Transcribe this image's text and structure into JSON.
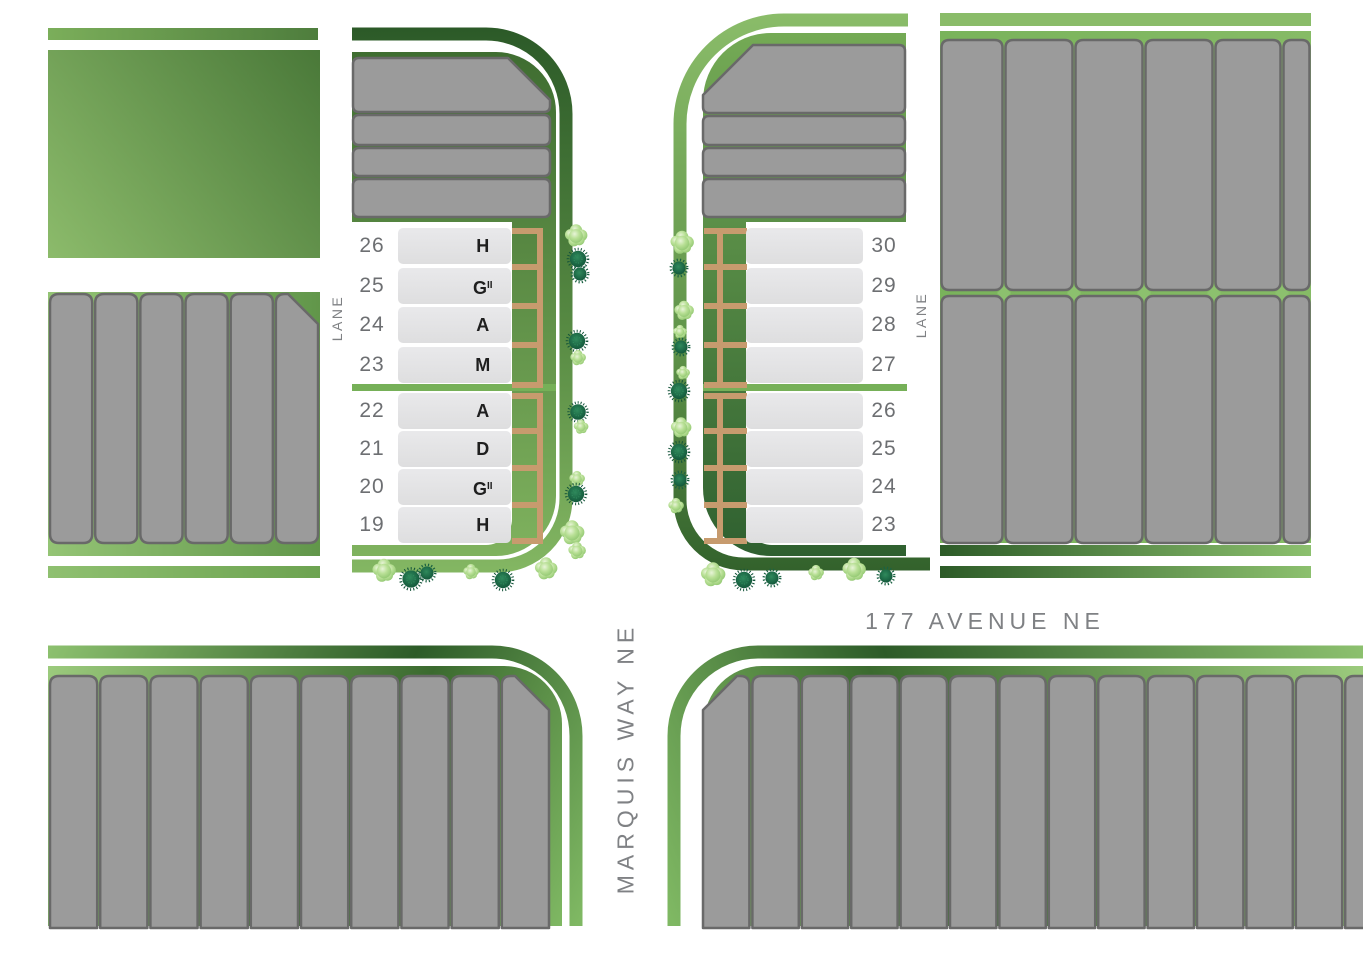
{
  "labels": {
    "avenue": "177 AVENUE NE",
    "way": "MARQUIS WAY NE",
    "lane_west": "LANE",
    "lane_east": "LANE"
  },
  "left_panel": {
    "groups": [
      {
        "lots": [
          {
            "number": "26",
            "model": "H",
            "model_sup": ""
          },
          {
            "number": "25",
            "model": "G",
            "model_sup": "II"
          },
          {
            "number": "24",
            "model": "A",
            "model_sup": ""
          },
          {
            "number": "23",
            "model": "M",
            "model_sup": ""
          }
        ]
      },
      {
        "lots": [
          {
            "number": "22",
            "model": "A",
            "model_sup": ""
          },
          {
            "number": "21",
            "model": "D",
            "model_sup": ""
          },
          {
            "number": "20",
            "model": "G",
            "model_sup": "II"
          },
          {
            "number": "19",
            "model": "H",
            "model_sup": ""
          }
        ]
      }
    ]
  },
  "right_panel": {
    "groups": [
      {
        "lots": [
          {
            "number": "30"
          },
          {
            "number": "29"
          },
          {
            "number": "28"
          },
          {
            "number": "27"
          }
        ]
      },
      {
        "lots": [
          {
            "number": "26"
          },
          {
            "number": "25"
          },
          {
            "number": "24"
          },
          {
            "number": "23"
          }
        ]
      }
    ]
  },
  "blocks": {
    "west_block_lots": 6,
    "left_inner_rows": 4,
    "right_inner_rows": 4,
    "east_block_rows": 2,
    "east_block_columns": 6,
    "southwest_lots": 10,
    "southeast_lots": 14
  },
  "colors": {
    "number_text": "#6d6f72",
    "model_text": "#1f1f1f",
    "label_text": "#7f8184",
    "lot_gray": "#9b9b9b",
    "lot_stroke": "#696969",
    "fence_tan": "#c79b6e",
    "divider_green": "#76b058",
    "diamond_green": "#8cc06e",
    "road_dark": "#2d5b28",
    "road_mid": "#5f9349",
    "road_light": "#8abc69",
    "conifer_dark": "#14543a",
    "shrub_light": "#b9e096"
  },
  "trees": [
    {
      "type": "shrub",
      "x": 576,
      "y": 236,
      "s": 1.15
    },
    {
      "type": "conifer",
      "x": 578,
      "y": 259,
      "s": 1.0
    },
    {
      "type": "dot",
      "x": 580,
      "y": 274,
      "s": 1.0
    },
    {
      "type": "conifer",
      "x": 577,
      "y": 341,
      "s": 1.0
    },
    {
      "type": "shrub",
      "x": 578,
      "y": 358,
      "s": 0.8
    },
    {
      "type": "conifer",
      "x": 578,
      "y": 412,
      "s": 0.95
    },
    {
      "type": "shrub",
      "x": 581,
      "y": 427,
      "s": 0.75
    },
    {
      "type": "shrub",
      "x": 577,
      "y": 479,
      "s": 0.8
    },
    {
      "type": "conifer",
      "x": 576,
      "y": 494,
      "s": 1.0
    },
    {
      "type": "shrub",
      "x": 572,
      "y": 533,
      "s": 1.25
    },
    {
      "type": "shrub",
      "x": 384,
      "y": 571,
      "s": 1.2
    },
    {
      "type": "conifer",
      "x": 411,
      "y": 579,
      "s": 1.05
    },
    {
      "type": "dot",
      "x": 427,
      "y": 573,
      "s": 1.0
    },
    {
      "type": "shrub",
      "x": 471,
      "y": 572,
      "s": 0.8
    },
    {
      "type": "conifer",
      "x": 503,
      "y": 580,
      "s": 1.0
    },
    {
      "type": "shrub",
      "x": 546,
      "y": 569,
      "s": 1.15
    },
    {
      "type": "shrub",
      "x": 577,
      "y": 551,
      "s": 0.9
    },
    {
      "type": "shrub",
      "x": 682,
      "y": 243,
      "s": 1.2
    },
    {
      "type": "dot",
      "x": 679,
      "y": 268,
      "s": 1.0
    },
    {
      "type": "shrub",
      "x": 684,
      "y": 311,
      "s": 1.0
    },
    {
      "type": "shrub",
      "x": 680,
      "y": 332,
      "s": 0.7
    },
    {
      "type": "dot",
      "x": 681,
      "y": 347,
      "s": 1.0
    },
    {
      "type": "shrub",
      "x": 683,
      "y": 373,
      "s": 0.7
    },
    {
      "type": "conifer",
      "x": 679,
      "y": 391,
      "s": 1.0
    },
    {
      "type": "shrub",
      "x": 681,
      "y": 428,
      "s": 1.05
    },
    {
      "type": "conifer",
      "x": 679,
      "y": 452,
      "s": 1.0
    },
    {
      "type": "dot",
      "x": 680,
      "y": 480,
      "s": 1.0
    },
    {
      "type": "shrub",
      "x": 676,
      "y": 506,
      "s": 0.8
    },
    {
      "type": "shrub",
      "x": 713,
      "y": 575,
      "s": 1.25
    },
    {
      "type": "conifer",
      "x": 744,
      "y": 580,
      "s": 1.0
    },
    {
      "type": "dot",
      "x": 772,
      "y": 578,
      "s": 1.0
    },
    {
      "type": "shrub",
      "x": 816,
      "y": 573,
      "s": 0.8
    },
    {
      "type": "shrub",
      "x": 854,
      "y": 570,
      "s": 1.2
    },
    {
      "type": "dot",
      "x": 886,
      "y": 576,
      "s": 1.0
    }
  ]
}
